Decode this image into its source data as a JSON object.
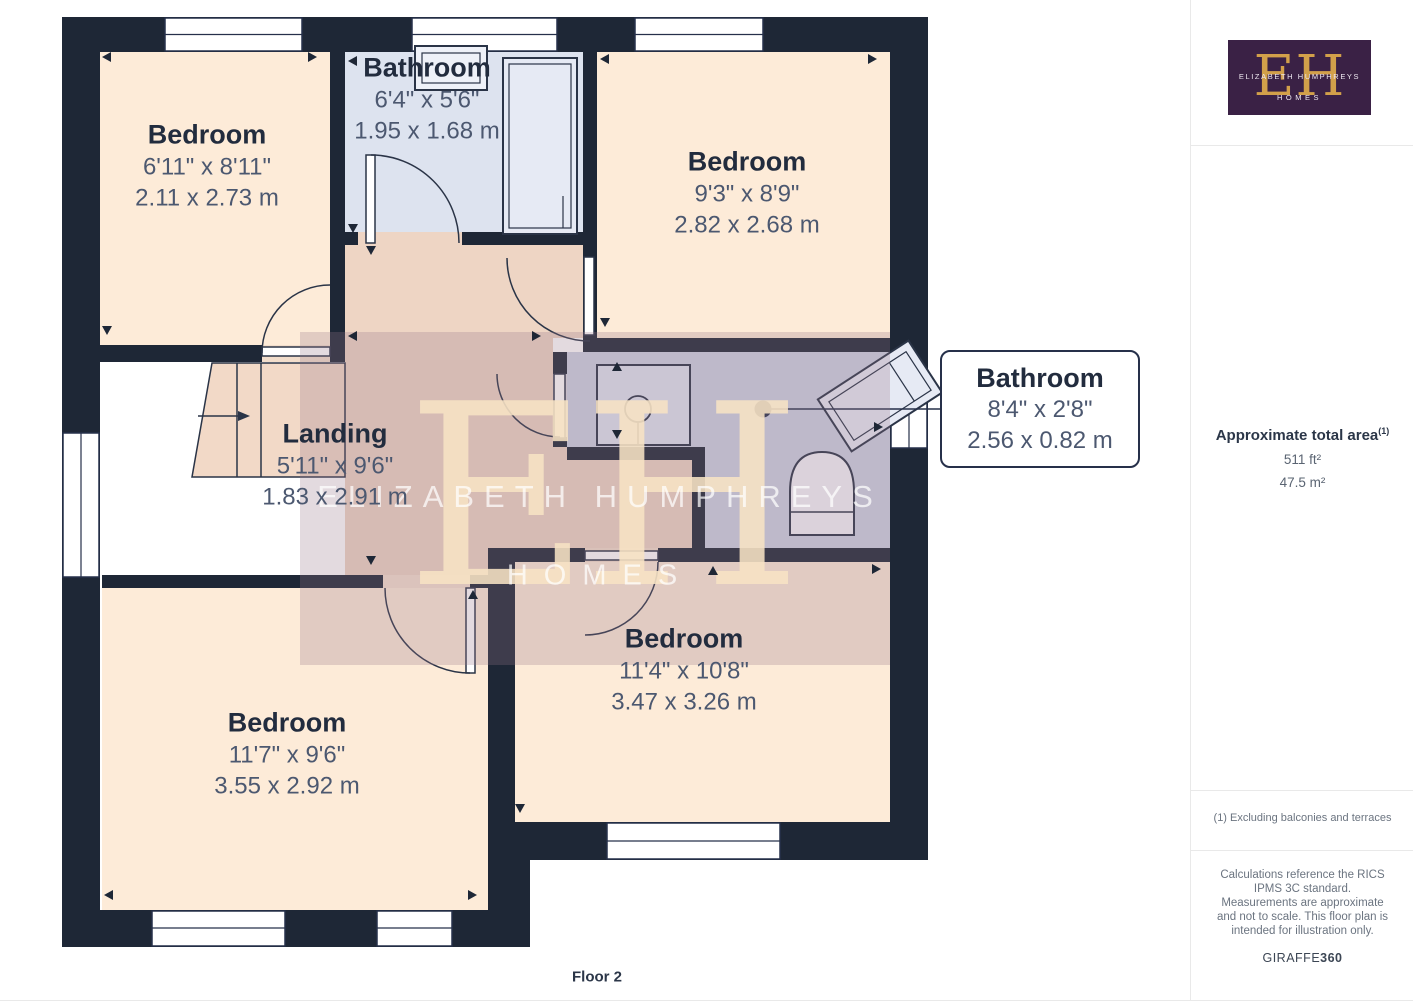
{
  "floor_label": "Floor 2",
  "rooms": {
    "bedroom_tl": {
      "name": "Bedroom",
      "imperial": "6'11\" x 8'11\"",
      "metric": "2.11 x 2.73 m"
    },
    "bathroom_top": {
      "name": "Bathroom",
      "imperial": "6'4\" x 5'6\"",
      "metric": "1.95 x 1.68 m"
    },
    "bedroom_tr": {
      "name": "Bedroom",
      "imperial": "9'3\" x 8'9\"",
      "metric": "2.82 x 2.68 m"
    },
    "landing": {
      "name": "Landing",
      "imperial": "5'11\" x 9'6\"",
      "metric": "1.83 x 2.91 m"
    },
    "bathroom_mid": {
      "name": "Bathroom",
      "imperial": "8'4\" x 2'8\"",
      "metric": "2.56 x 0.82 m"
    },
    "bedroom_bl": {
      "name": "Bedroom",
      "imperial": "11'7\" x 9'6\"",
      "metric": "3.55 x 2.92 m"
    },
    "bedroom_br": {
      "name": "Bedroom",
      "imperial": "11'4\" x 10'8\"",
      "metric": "3.47 x 3.26 m"
    }
  },
  "watermark": {
    "monogram": "EH",
    "line1": "ELIZABETH HUMPHREYS",
    "line2": "HOMES"
  },
  "sidebar": {
    "logo": {
      "monogram": "EH",
      "name": "ELIZABETH HUMPHREYS",
      "sub": "HOMES"
    },
    "area_title": "Approximate total area",
    "area_superscript": "(1)",
    "area_ft": "511 ft²",
    "area_m": "47.5 m²",
    "note": "(1) Excluding balconies and terraces",
    "disclaimer": "Calculations reference the RICS IPMS 3C standard. Measurements are approximate and not to scale. This floor plan is intended for illustration only.",
    "brand": "GIRAFFE",
    "brand_bold": "360"
  },
  "colors": {
    "wall": "#1e2736",
    "bedroom_floor": "#fdebd8",
    "bathroom_floor": "#dde3ef",
    "landing_floor": "#eed5c4",
    "highlight_overlay": "rgba(150,120,136,0.27)",
    "logo_purple": "#3a2145",
    "logo_gold": "#d2a04a",
    "watermark_cream": "#f7e3c4"
  }
}
